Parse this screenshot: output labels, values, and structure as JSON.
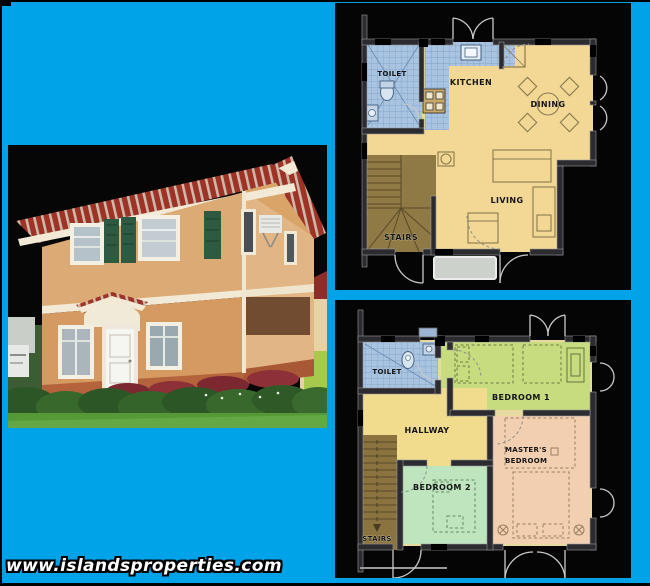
{
  "page": {
    "background_color": "#00a2e8",
    "border_color": "#000000",
    "watermark": "www.islandsproperties.com"
  },
  "house_photo": {
    "description": "two-storey house exterior photo on black background",
    "colors": {
      "roof": "#9e3226",
      "roof_tile_light": "#cdb9a8",
      "wall_upper": "#dcaa74",
      "wall_lower": "#d59a62",
      "wall_side": "#e2b584",
      "base_band": "#b5633c",
      "trim": "#f2ead6",
      "shutters": "#2d5a41",
      "hedge": "#2d5626",
      "grass": "#569a38"
    }
  },
  "floor_plans": {
    "ground": {
      "rooms": {
        "toilet": "TOILET",
        "kitchen": "KITCHEN",
        "dining": "DINING",
        "living": "LIVING",
        "stairs": "STAIRS"
      },
      "colors": {
        "floor": "#f2d894",
        "tiles": "#a9c4e1",
        "stairs": "#8f7a45",
        "mat": "#cdd1cb",
        "wall": "#2b2b30"
      }
    },
    "second": {
      "rooms": {
        "toilet": "TOILET",
        "bedroom1": "BEDROOM 1",
        "hallway": "HALLWAY",
        "master_line1": "MASTER'S",
        "master_line2": "BEDROOM",
        "bedroom2": "BEDROOM 2",
        "stairs": "STAIRS"
      },
      "colors": {
        "base": "#e8d9a0",
        "tiles": "#a9c4e1",
        "bedroom1": "#c6dc7e",
        "hallway": "#f0dc8c",
        "master": "#f2cfb0",
        "bedroom2": "#bfe5be",
        "stairs": "#8b7340",
        "wall": "#2b2b30"
      }
    }
  }
}
